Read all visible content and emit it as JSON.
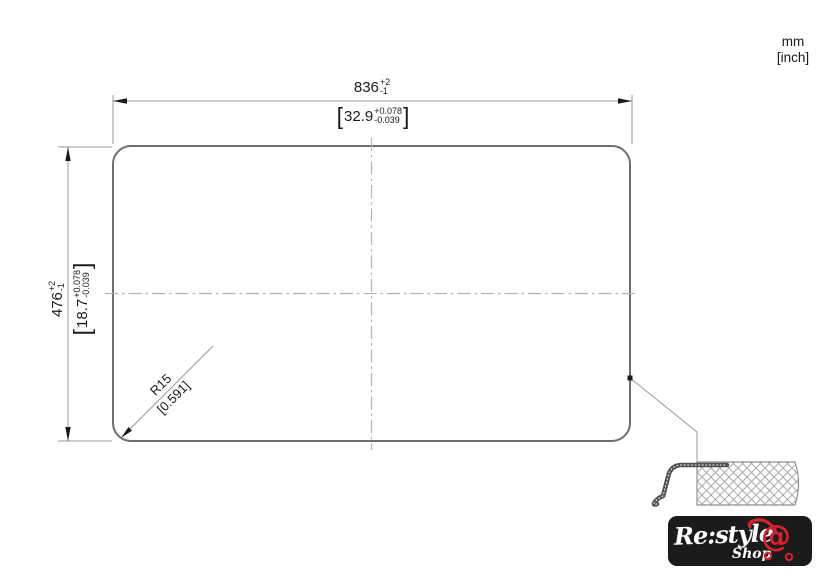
{
  "units_label": {
    "metric": "mm",
    "imperial": "[inch]"
  },
  "dimensions": {
    "width": {
      "mm": "836",
      "plus": "+2",
      "minus": "-1",
      "inch_open": "[",
      "inch": "32.9",
      "inch_plus": "+0.078",
      "inch_minus": "-0.039",
      "inch_close": "]"
    },
    "height": {
      "mm": "476",
      "plus": "+2",
      "minus": "-1",
      "inch_open": "[",
      "inch": "18.7",
      "inch_plus": "+0.078",
      "inch_minus": "-0.039",
      "inch_close": "]"
    },
    "corner_radius": {
      "mm": "R15",
      "inch": "[0.591]"
    }
  },
  "logo": {
    "brand": "Re:style",
    "sub": "Shop",
    "cart_symbol": "@"
  },
  "colors": {
    "outline": "#6e6e6e",
    "dim_line": "#999999",
    "centerline": "#b3b3b3",
    "text": "#1a1a1a",
    "logo_bg": "#1b1b1b",
    "logo_red": "#d5222d",
    "logo_text": "#ffffff"
  }
}
